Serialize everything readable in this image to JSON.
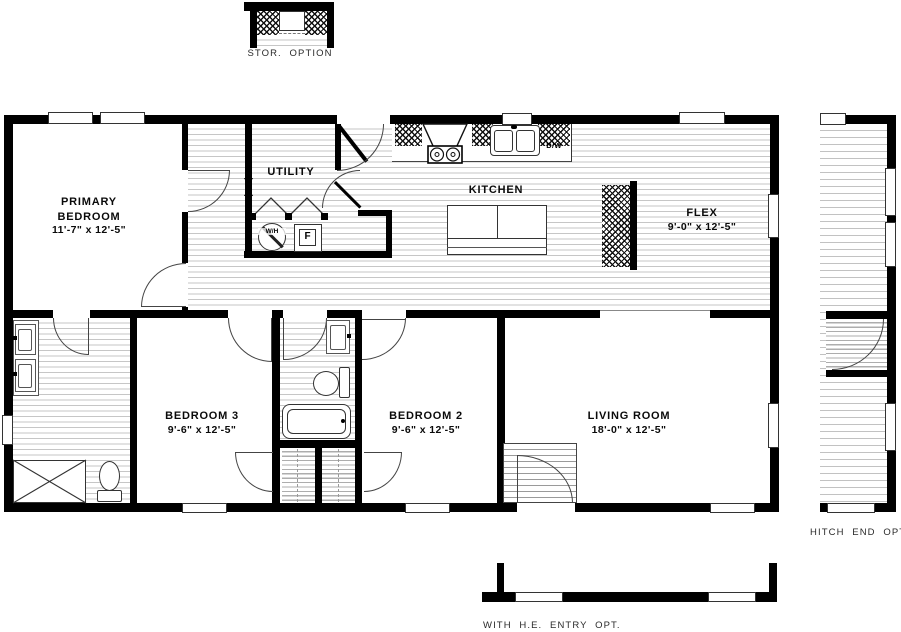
{
  "plan": {
    "options": {
      "storage_label": "STOR. OPTION",
      "hitch_label": "HITCH END OPT.",
      "entry_label": "WITH H.E. ENTRY OPT."
    },
    "rooms": {
      "primary_bedroom": {
        "name": "PRIMARY\nBEDROOM",
        "dims": "11'-7\" x  12'-5\""
      },
      "utility": {
        "name": "UTILITY"
      },
      "kitchen": {
        "name": "KITCHEN"
      },
      "flex": {
        "name": "FLEX",
        "dims": "9'-0\" x  12'-5\""
      },
      "bedroom3": {
        "name": "BEDROOM 3",
        "dims": "9'-6\" x  12'-5\""
      },
      "bedroom2": {
        "name": "BEDROOM 2",
        "dims": "9'-6\" x  12'-5\""
      },
      "living_room": {
        "name": "LIVING ROOM",
        "dims": "18'-0\" x  12'-5\""
      }
    },
    "labels": {
      "water_heater": "W/H",
      "furnace": "F",
      "dishwasher": "D/W"
    },
    "colors": {
      "wall": "#000000",
      "line": "#333333",
      "floor_stripe": "#c6c6c6"
    }
  }
}
